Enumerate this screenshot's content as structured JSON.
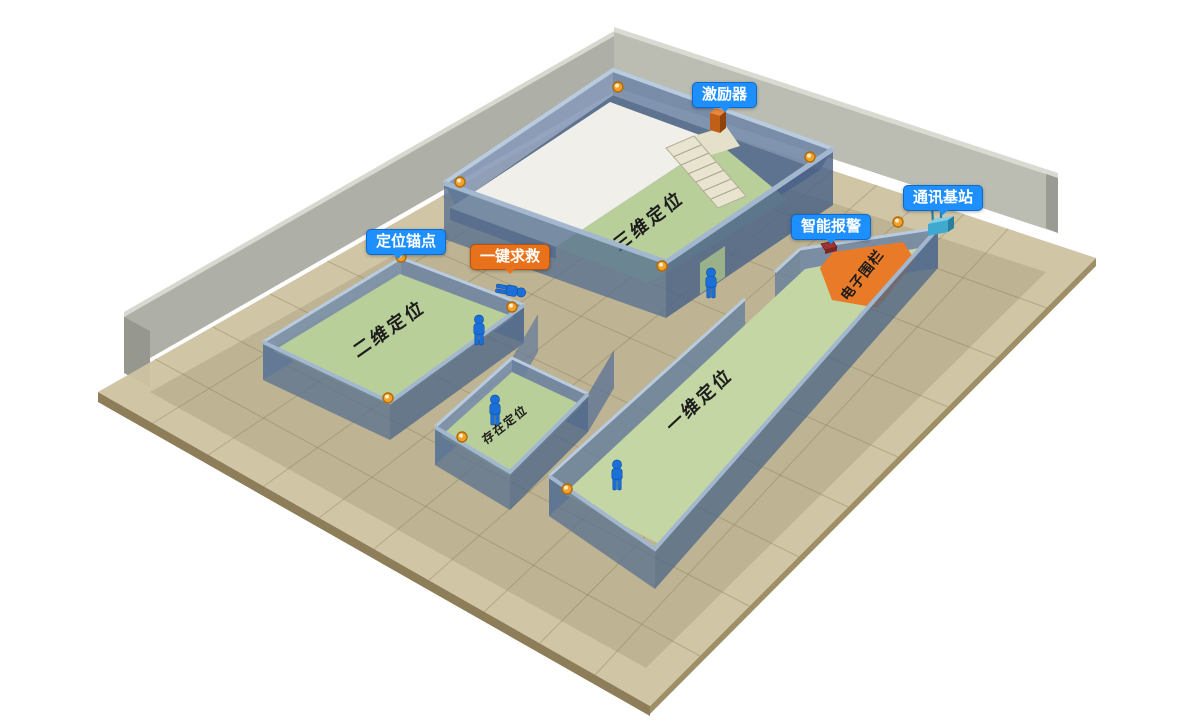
{
  "callouts": {
    "exciter": {
      "label": "激励器"
    },
    "comm_base": {
      "label": "通讯基站"
    },
    "smart_alarm": {
      "label": "智能报警"
    },
    "anchor_point": {
      "label": "定位锚点"
    },
    "sos": {
      "label": "一键求救"
    }
  },
  "zones": {
    "zone_3d": {
      "label": "三维定位"
    },
    "zone_2d": {
      "label": "二维定位"
    },
    "zone_1d": {
      "label": "一维定位"
    },
    "presence": {
      "label": "存在定位"
    },
    "fence": {
      "label": "电子围栏"
    }
  },
  "entities": {
    "anchors": 10,
    "persons_standing": 4,
    "persons_fallen": 1
  },
  "colors": {
    "callout_blue": "#1e8fff",
    "callout_orange": "#e8721c",
    "fence_orange": "#e87a28",
    "room_floor_green": "#b9cf9a",
    "corridor_floor_green": "#c3d6a4",
    "wall_blue": "#6d87ac",
    "person_blue": "#1a6fd8",
    "anchor_orange": "#f0a22c",
    "ground_tan": "#cdc2a0",
    "backdrop_gray": "#b7b8ae"
  }
}
